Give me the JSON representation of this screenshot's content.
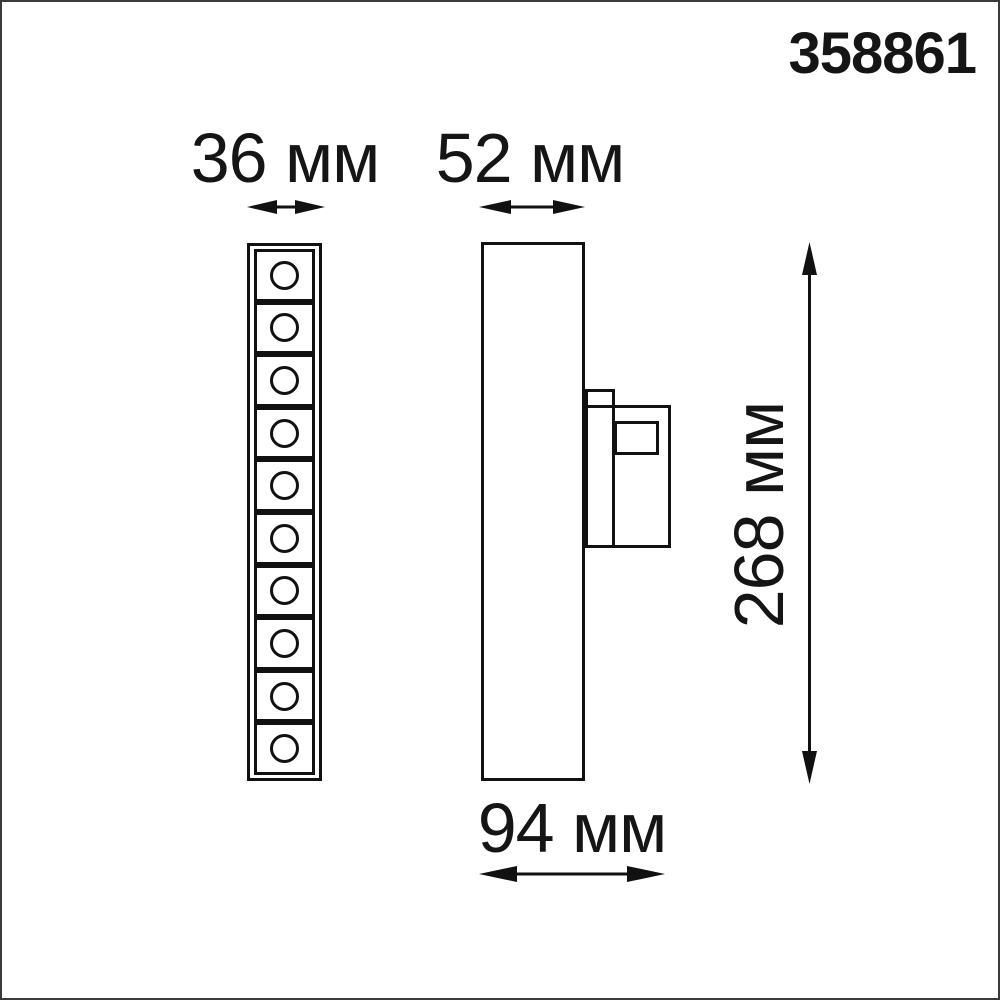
{
  "product_code": "358861",
  "dimensions": {
    "front_width": {
      "label": "36 мм",
      "value_mm": 36
    },
    "side_width": {
      "label": "52 мм",
      "value_mm": 52
    },
    "depth": {
      "label": "94 мм",
      "value_mm": 94
    },
    "height": {
      "label": "268 мм",
      "value_mm": 268
    }
  },
  "front_view": {
    "led_cells": 10
  },
  "colors": {
    "line": "#111111",
    "background": "#ffffff",
    "page_border": "#3a3a3a"
  }
}
